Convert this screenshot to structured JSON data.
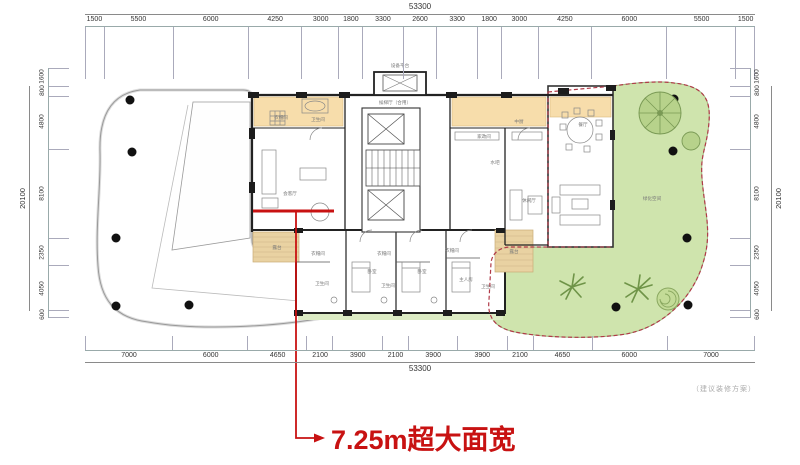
{
  "annotation": {
    "width_label": "7.25m超大面宽",
    "plan_note": "（建议装修方案）"
  },
  "dimensions": {
    "top": {
      "total": "53300",
      "segments": [
        "1500",
        "5500",
        "6000",
        "4250",
        "3000",
        "1800",
        "3300",
        "2600",
        "3300",
        "1800",
        "3000",
        "4250",
        "6000",
        "5500",
        "1500"
      ]
    },
    "bottom": {
      "total": "53300",
      "segments": [
        "7000",
        "6000",
        "4650",
        "2100",
        "3900",
        "2100",
        "3900",
        "3900",
        "2100",
        "4650",
        "6000",
        "7000"
      ]
    },
    "left": {
      "total": "20100",
      "segments": [
        "1600",
        "800",
        "4800",
        "8100",
        "2350",
        "4050",
        "600"
      ]
    },
    "right": {
      "total": "20100",
      "segments": [
        "1600",
        "800",
        "4800",
        "8100",
        "2350",
        "4050",
        "600"
      ]
    }
  },
  "plan": {
    "labels": {
      "equipment_platform": "设备平台",
      "elevator_lobby": "候梯厅（合用）",
      "closet_top": "衣帽间",
      "bathroom_top": "卫生间",
      "living_room": "会客厅",
      "terrace_left": "露台",
      "terrace_right": "露台",
      "housekeeping": "家政间",
      "kitchen": "中厨",
      "water_bar": "水吧",
      "lounge": "休闲厅",
      "dining_room": "餐厅",
      "green_space": "绿化空间",
      "closet_1": "衣帽间",
      "closet_2": "衣帽间",
      "closet_3": "衣帽间",
      "bedroom_1": "卧室",
      "bedroom_2": "卧室",
      "master_room": "主人房",
      "bath_1": "卫生间",
      "bath_2": "卫生间",
      "bath_3": "卫生间"
    }
  },
  "colors": {
    "highlight_red": "#c81212",
    "boundary_red": "#b03a48",
    "garden_green": "#cfe4ad",
    "lawn_strip": "#dcebc4",
    "floor_orange": "#f7ddab",
    "deck_tan": "#e9d2a2",
    "wall_black": "#1c1c1c"
  }
}
